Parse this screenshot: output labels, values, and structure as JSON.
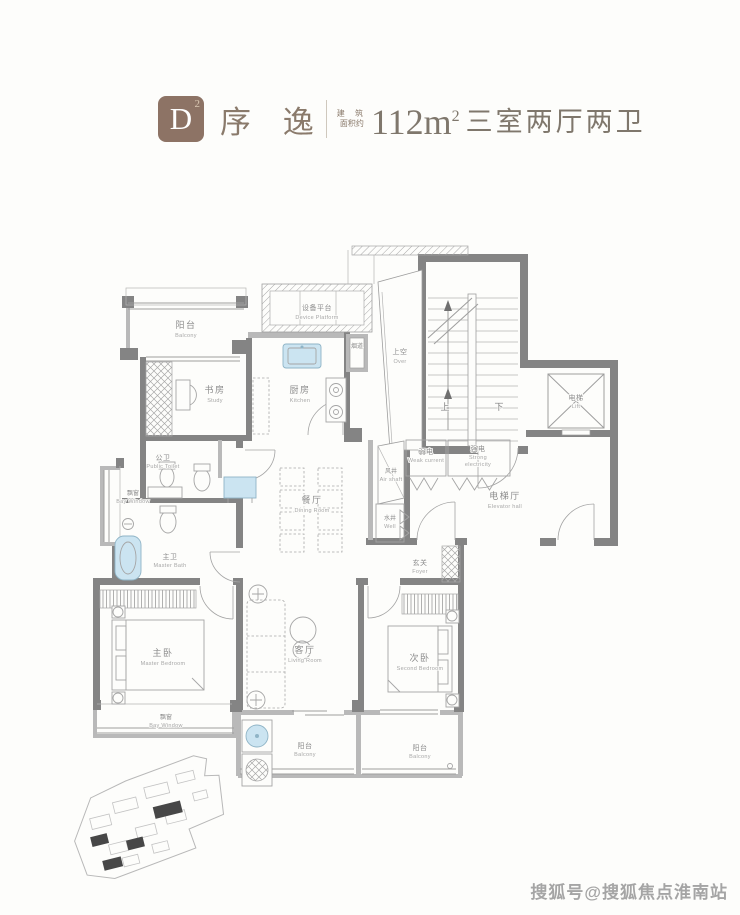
{
  "header": {
    "badge_letter": "D",
    "badge_sup": "2",
    "title": "序 逸",
    "area_label_l1": "建 筑",
    "area_label_l2": "面积约",
    "area_value": "112m",
    "area_sup": "2",
    "spec": "三室两厅两卫"
  },
  "plan": {
    "rooms": [
      {
        "zh": "阳台",
        "en": "Balcony"
      },
      {
        "zh": "设备平台",
        "en": "Device Platform"
      },
      {
        "zh": "书房",
        "en": "Study"
      },
      {
        "zh": "厨房",
        "en": "Kitchen"
      },
      {
        "zh": "上空",
        "en": "Over"
      },
      {
        "zh": "电梯",
        "en": "Lift"
      },
      {
        "zh": "公卫",
        "en": "Public Toilet"
      },
      {
        "zh": "飘窗",
        "en": "Bay Window"
      },
      {
        "zh": "弱电",
        "en": "Weak current"
      },
      {
        "zh": "强电",
        "en": "Strong",
        "en2": "electricity"
      },
      {
        "zh": "风井",
        "en": "Air shaft"
      },
      {
        "zh": "水井",
        "en": "Well"
      },
      {
        "zh": "电梯厅",
        "en": "Elevator hall"
      },
      {
        "zh": "餐厅",
        "en": "Dining Room"
      },
      {
        "zh": "主卫",
        "en": "Master Bath"
      },
      {
        "zh": "玄关",
        "en": "Foyer"
      },
      {
        "zh": "主卧",
        "en": "Master Bedroom"
      },
      {
        "zh": "客厅",
        "en": "Living Room"
      },
      {
        "zh": "次卧",
        "en": "Second Bedroom"
      },
      {
        "zh": "飘窗",
        "en": "Bay Window"
      },
      {
        "zh": "阳台",
        "en": "Balcony"
      },
      {
        "zh": "阳台",
        "en": "Balcony"
      },
      {
        "zh": "烟道",
        "en": ""
      }
    ],
    "stair": {
      "up": "上",
      "down": "下"
    }
  },
  "watermark": "搜狐号@搜狐焦点淮南站",
  "colors": {
    "accent": "#8d7365",
    "title_text": "#8a7a6b",
    "wall_dark": "#848484",
    "wall_light": "#b9b9b9",
    "fixture_blue": "#cbe4f1"
  }
}
